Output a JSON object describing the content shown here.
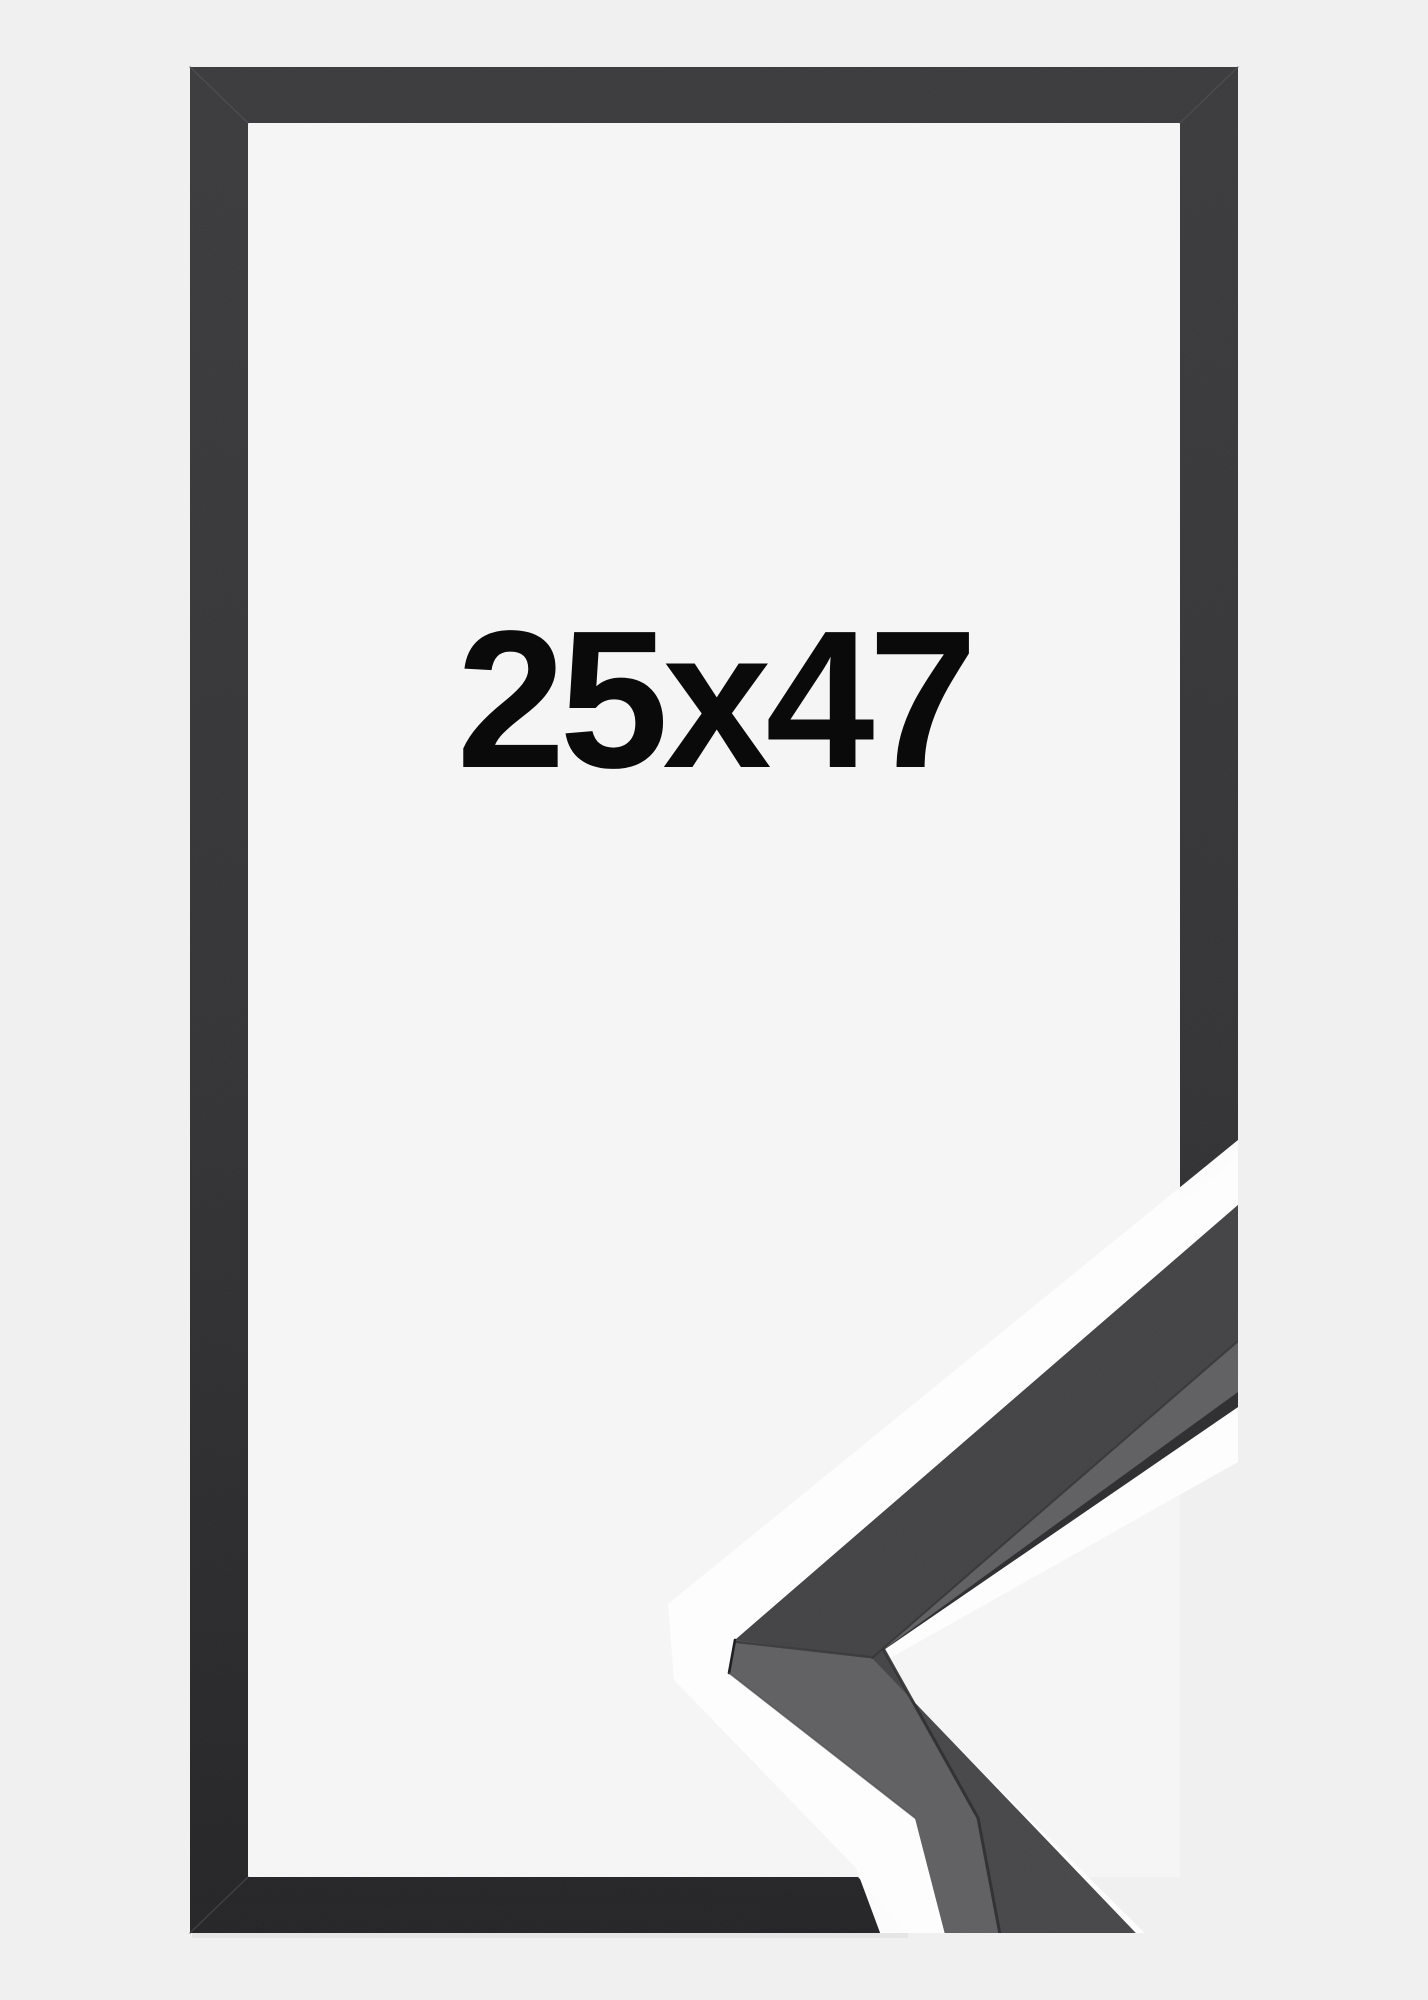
{
  "product_image": {
    "kind": "picture-frame product photo",
    "size_label": "25x47",
    "colors": {
      "background": "#f0f0f1",
      "paper": "#f5f5f6",
      "halo": "#fdfdfe",
      "label": "#0a0a0b",
      "frame_top": "#3b3b3d",
      "frame_bottom": "#242426",
      "sample_front_upper": "#434345",
      "sample_front_lower": "#474749",
      "sample_side": "#606062",
      "sample_edge": "#2e2e30",
      "miter_seam": "#4a4a4c"
    },
    "frame": {
      "description": "thin matte black frame, front view",
      "size_label": "25x47"
    },
    "corner_sample": {
      "description": "mitered corner moulding profile, 3d detail view"
    }
  }
}
